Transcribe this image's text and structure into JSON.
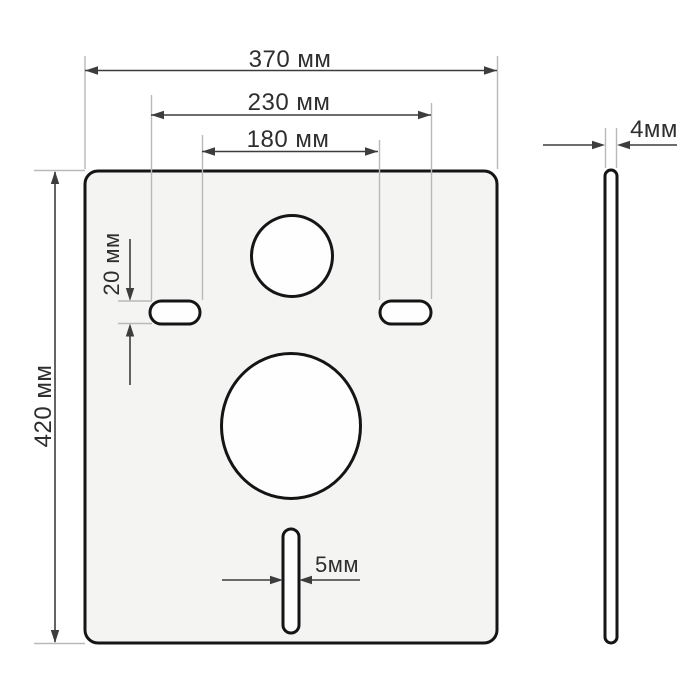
{
  "dimensions": {
    "overall_width": {
      "label": "370 мм",
      "value_mm": 370
    },
    "slots_outer_span": {
      "label": "230 мм",
      "value_mm": 230
    },
    "slots_inner_span": {
      "label": "180 мм",
      "value_mm": 180
    },
    "overall_height": {
      "label": "420 мм",
      "value_mm": 420
    },
    "mount_slot_height": {
      "label": "20 мм",
      "value_mm": 20
    },
    "bottom_slot_width": {
      "label": "5мм",
      "value_mm": 5
    },
    "thickness": {
      "label": "4мм",
      "value_mm": 4
    }
  },
  "colors": {
    "background": "#ffffff",
    "plate_fill": "#f4f4f3",
    "hole_fill": "#fefefe",
    "outline": "#151515",
    "dimension_line": "#3d3d3d",
    "extension_line": "#b9b9b9",
    "text_color": "#2e2e2e"
  }
}
